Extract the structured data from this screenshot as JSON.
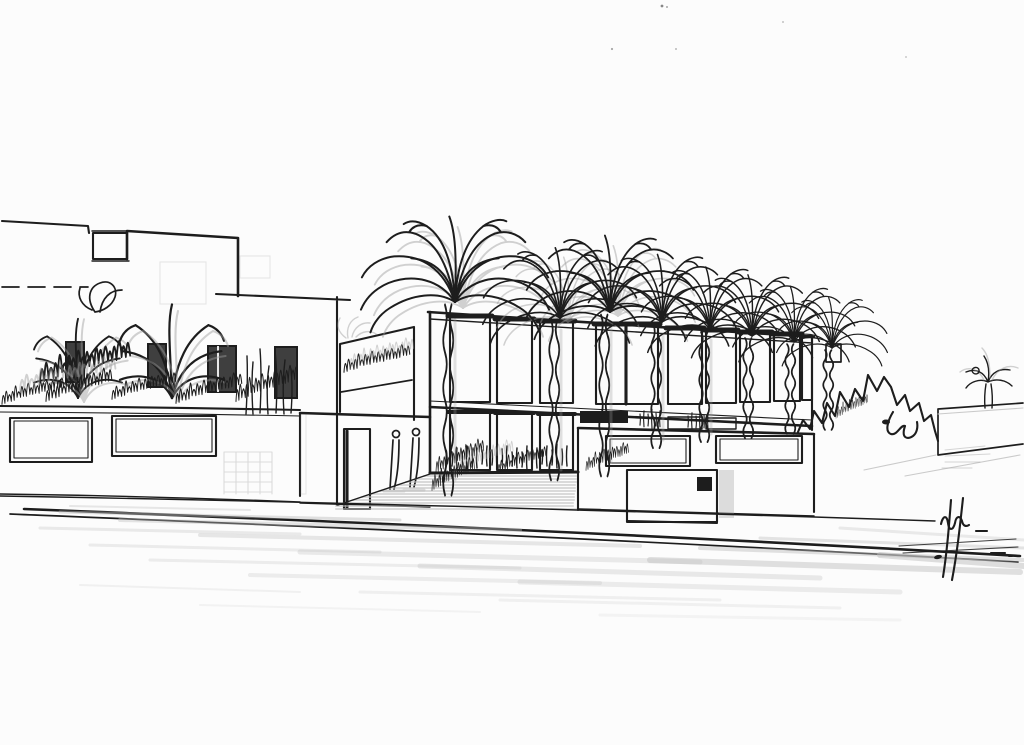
{
  "page": {
    "title": "Architectural concept sketch — villa street perspective"
  },
  "colors": {
    "paper": "#fcfcfc",
    "ink": "#1d1d1d",
    "ink-soft": "#3f3f3f",
    "pencil": "#9c9c9c",
    "pencil-light": "#cacaca",
    "asphalt": "#bdbdbd"
  },
  "scene": {
    "description": "Black-and-white ink and pencil architectural sketch: a street-level perspective of a modern flat-roofed villa. On the left, a stepped white building with dark window openings, a crosshatched parapet panel and a garden wall with two crosshatched lattice panels behind shrub scribbles. In the center, a tall two-storey facade of gridded curtain-wall windows with a row of eight palm trees in front and two small human figures at the entrance. To the right, a boundary wall with crosshatch panels, a vertically slatted gate with a dark intercom box, a scribbled hedge, a low receding wall and a small palm. A pencil-shaded asphalt road with kerb lines crosses the foreground; an illegible signature scrawl sits at lower right.",
    "medium": "ink pen with pencil shading on white paper",
    "elements": [
      {
        "name": "left-villa",
        "label": "Stepped flat-roof villa, dark window openings, crosshatch parapet panel"
      },
      {
        "name": "left-garden-wall",
        "label": "Garden wall with two crosshatched lattice panels and shrub scribbles"
      },
      {
        "name": "main-villa-facade",
        "label": "Two-storey gridded curtain-wall facade"
      },
      {
        "name": "palm-row",
        "label": "Row of palm trees in front of the facade",
        "count": 8
      },
      {
        "name": "pedestrians",
        "label": "Two sketched figures at the entrance",
        "count": 2
      },
      {
        "name": "front-wall-right",
        "label": "Boundary wall with crosshatch panels, slatted gate, intercom box"
      },
      {
        "name": "right-garden",
        "label": "Scribbled hedge, low perspective wall, small palm"
      },
      {
        "name": "street",
        "label": "Foreground road, pencil-shaded asphalt, kerb lines"
      },
      {
        "name": "signature",
        "label": "Illegible artist initials scrawl, lower right"
      }
    ]
  }
}
